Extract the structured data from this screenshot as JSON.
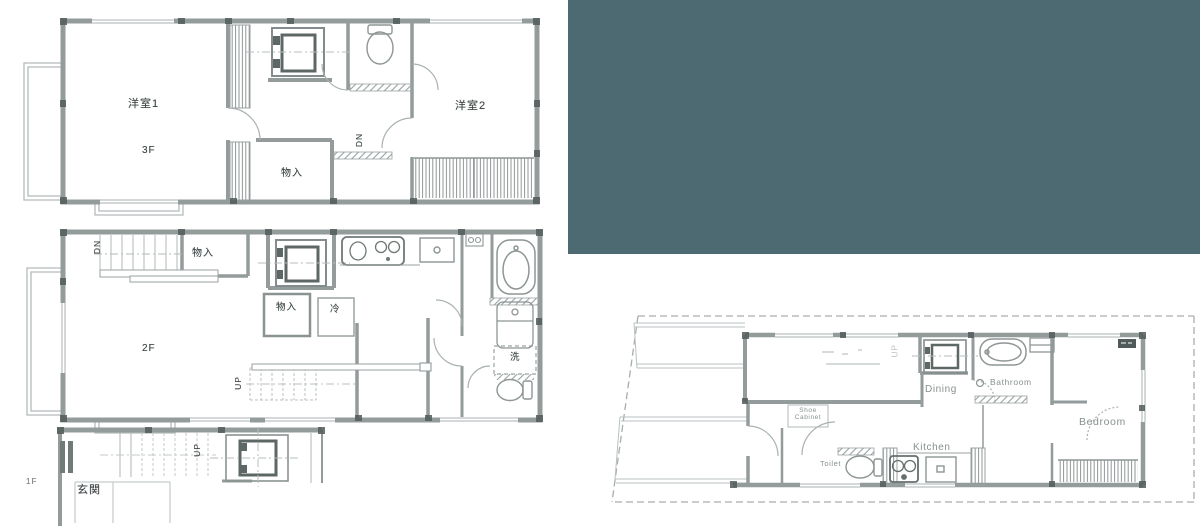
{
  "colors": {
    "overlay": "#4d6a72"
  },
  "floor3": {
    "room1": "洋室1",
    "floor_label": "3F",
    "room2": "洋室2",
    "storage": "物入",
    "stairs_down": "DN"
  },
  "floor2": {
    "stairs_down": "DN",
    "storage_top": "物入",
    "storage_mid": "物入",
    "fridge": "冷",
    "floor_label": "2F",
    "laundry": "洗",
    "stairs_up": "UP"
  },
  "floor1": {
    "floor_label": "1F",
    "entrance": "玄関",
    "stairs_up": "UP"
  },
  "site": {
    "stairs_mark": "UP",
    "dining": "Dining",
    "bathroom": "Bathroom",
    "bedroom": "Bedroom",
    "kitchen": "Kitchen",
    "toilet": "Toilet",
    "shoe_line1": "Shoe",
    "shoe_line2": "Cabinet"
  }
}
